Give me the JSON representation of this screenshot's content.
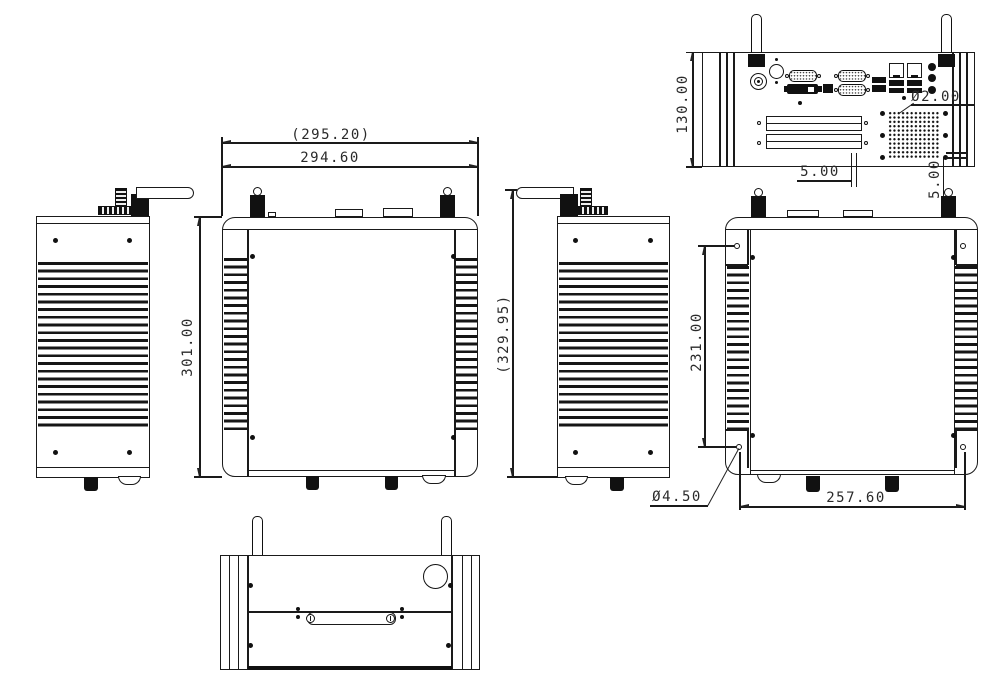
{
  "colors": {
    "background": "#ffffff",
    "line": "#1a1a1a",
    "text": "#2a2a2a"
  },
  "dimensions": {
    "top_width_ref": "(295.20)",
    "top_width": "294.60",
    "top_depth": "301.00",
    "side_height_ref": "(329.95)",
    "rear_height": "130.00",
    "vent_hole_dia": "Ø2.00",
    "vent_pitch_h": "5.00",
    "vent_pitch_v": "5.00",
    "mount_pitch_v": "231.00",
    "mount_pitch_h": "257.60",
    "mount_hole_dia": "Ø4.50"
  },
  "rear_panel_ports": [
    "dc-power-jack",
    "power-button",
    "vga-port",
    "serial-port-1",
    "dvi-port",
    "displayport",
    "serial-port-2",
    "usb-stack",
    "lan-port-1",
    "lan-port-2",
    "audio-jacks",
    "expansion-slot-1",
    "expansion-slot-2",
    "vent-hole-grid"
  ]
}
